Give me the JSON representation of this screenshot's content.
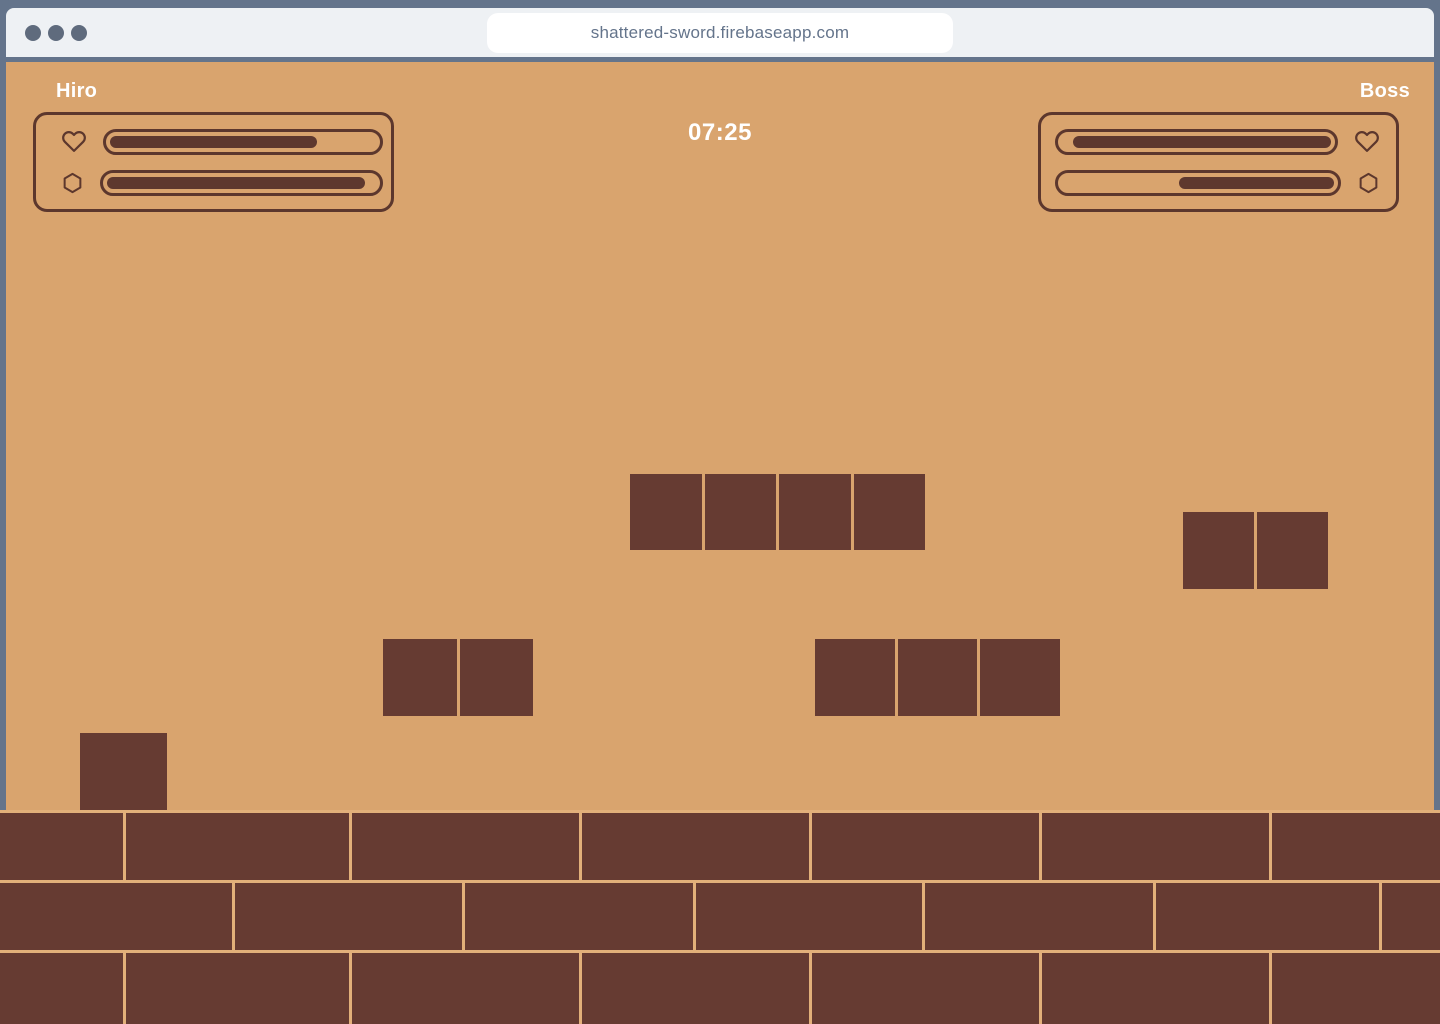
{
  "browser": {
    "url": "shattered-sword.firebaseapp.com",
    "window_controls": [
      "close",
      "minimize",
      "maximize"
    ]
  },
  "colors": {
    "frame": "#64748B",
    "toolbar": "#EEF1F4",
    "traffic": "#5F6B7D",
    "url_text": "#64748B",
    "bg": "#D9A46E",
    "mortar": "#E2B07A",
    "brick": "#663B32",
    "hud_stroke": "#5C372D",
    "hud_fill": "#5E382E",
    "text": "#FFFFFF"
  },
  "game": {
    "timer": "07:25",
    "players": [
      {
        "name": "Hiro",
        "side": "left",
        "health_pct": 78,
        "energy_pct": 96
      },
      {
        "name": "Boss",
        "side": "right",
        "health_pct": 96,
        "energy_pct": 57
      }
    ],
    "platforms": [
      {
        "x": 630,
        "y": 474,
        "width": 295,
        "height": 76,
        "tiles": 4
      },
      {
        "x": 1183,
        "y": 512,
        "width": 145,
        "height": 77,
        "tiles": 2
      },
      {
        "x": 383,
        "y": 639,
        "width": 150,
        "height": 77,
        "tiles": 2
      },
      {
        "x": 815,
        "y": 639,
        "width": 245,
        "height": 77,
        "tiles": 3
      },
      {
        "x": 80,
        "y": 733,
        "width": 87,
        "height": 77,
        "tiles": 1
      }
    ],
    "floor": {
      "top": 810,
      "height": 214,
      "rows": [
        {
          "top": 3,
          "height": 67,
          "separators": [
            124,
            350,
            580,
            810,
            1040,
            1270
          ]
        },
        {
          "top": 73,
          "height": 67,
          "separators": [
            233,
            463,
            694,
            923,
            1154,
            1380
          ]
        },
        {
          "top": 143,
          "height": 71,
          "separators": [
            124,
            350,
            580,
            810,
            1040,
            1270
          ]
        }
      ]
    }
  }
}
